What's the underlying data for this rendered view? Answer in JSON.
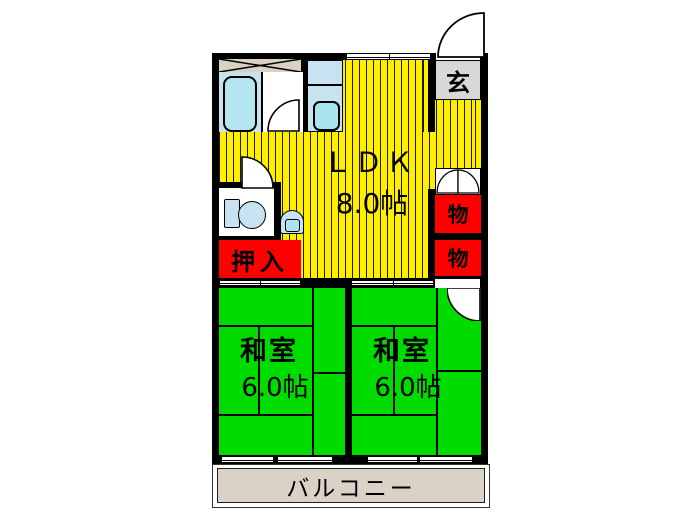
{
  "floorplan": {
    "rooms": {
      "ldk": {
        "label": "ＬＤＫ",
        "size": "8.0帖"
      },
      "entrance": {
        "label": "玄"
      },
      "storage_upper": {
        "label": "物"
      },
      "storage_lower": {
        "label": "物"
      },
      "oshiire": {
        "label": "押入"
      },
      "washitsu_left": {
        "label": "和室",
        "size": "6.0帖"
      },
      "washitsu_right": {
        "label": "和室",
        "size": "6.0帖"
      },
      "balcony": {
        "label": "バルコニー"
      }
    },
    "fixtures": [
      {
        "name": "bathtub"
      },
      {
        "name": "kitchen-sink"
      },
      {
        "name": "toilet"
      },
      {
        "name": "wash-basin"
      }
    ],
    "colors": {
      "ldk_yellow": "#FFEE00",
      "tatami_green": "#00DC00",
      "closet_red": "#FF0000",
      "entrance_gray": "#D8D8D8",
      "balcony_beige": "#D9D2C5",
      "fixture_blue": "#C7E3F2",
      "wall_black": "#000000"
    }
  }
}
